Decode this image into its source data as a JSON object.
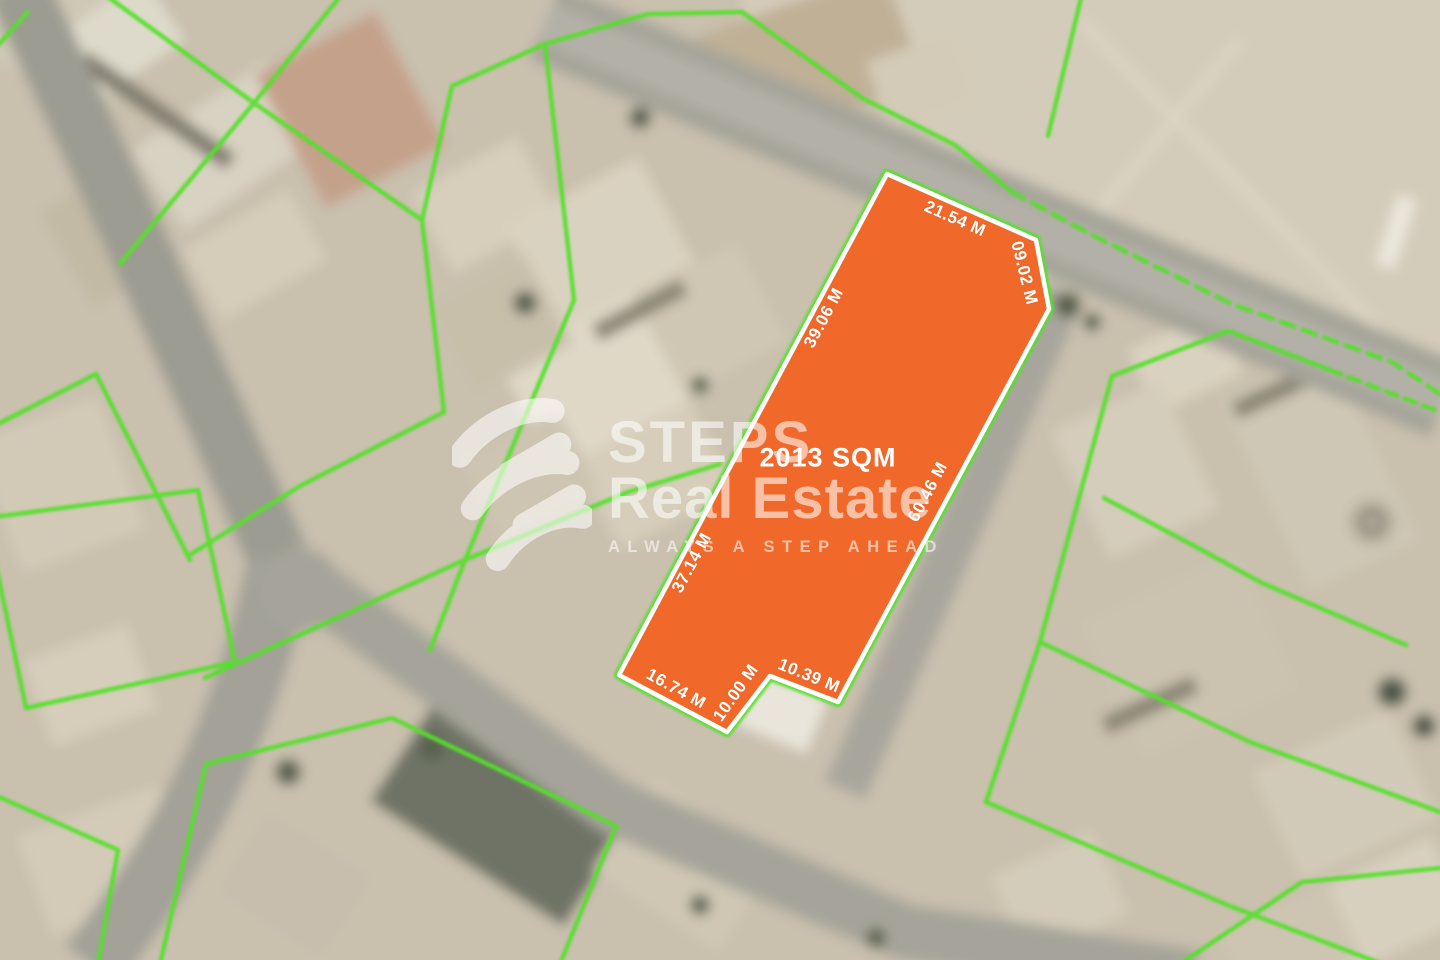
{
  "plot": {
    "area_label": "2013 SQM",
    "dimensions": [
      {
        "id": "top",
        "text": "21.54 M"
      },
      {
        "id": "top-right",
        "text": "09.02 M"
      },
      {
        "id": "left-upper",
        "text": "39.06 M"
      },
      {
        "id": "left-lower",
        "text": "37.14 M"
      },
      {
        "id": "right",
        "text": "60.46 M"
      },
      {
        "id": "bottom-left",
        "text": "16.74 M"
      },
      {
        "id": "bottom-middle",
        "text": "10.00 M"
      },
      {
        "id": "bottom-right",
        "text": "10.39 M"
      }
    ]
  },
  "watermark": {
    "brand_line1": "STEPS",
    "brand_line2": "Real Estate",
    "tagline": "ALWAYS A STEP AHEAD"
  },
  "colors": {
    "plot_fill": "#f0692a",
    "plot_border": "#ffffff",
    "boundary_green": "#55e02c",
    "map_base": "#c9c0ae",
    "road": "#a6a49a"
  }
}
